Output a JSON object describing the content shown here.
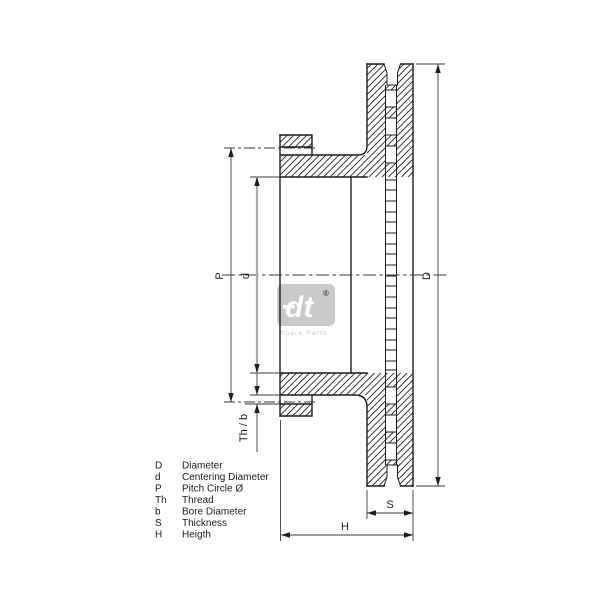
{
  "drawing": {
    "type": "brake-disc-cross-section",
    "dimension_labels": {
      "diameter": "D",
      "centering_diameter": "d",
      "pitch_circle": "P",
      "thread_bore": "Th / b",
      "thickness": "S",
      "height": "H"
    },
    "legend": [
      {
        "key": "D",
        "description": "Diameter"
      },
      {
        "key": "d",
        "description": "Centering Diameter"
      },
      {
        "key": "P",
        "description": "Pitch Circle Ø"
      },
      {
        "key": "Th",
        "description": "Thread"
      },
      {
        "key": "b",
        "description": "Bore Diameter"
      },
      {
        "key": "S",
        "description": "Thickness"
      },
      {
        "key": "H",
        "description": "Heigth"
      }
    ],
    "watermark": {
      "text": "dt",
      "registered": "®",
      "caption": "Spare Parts"
    },
    "colors": {
      "outline": "#1c1c1c",
      "dimension_line": "#3a3a3a",
      "centering_dim_line": "#a9a9a9",
      "watermark_gray": "#c9c9c9",
      "background": "#ffffff"
    }
  }
}
